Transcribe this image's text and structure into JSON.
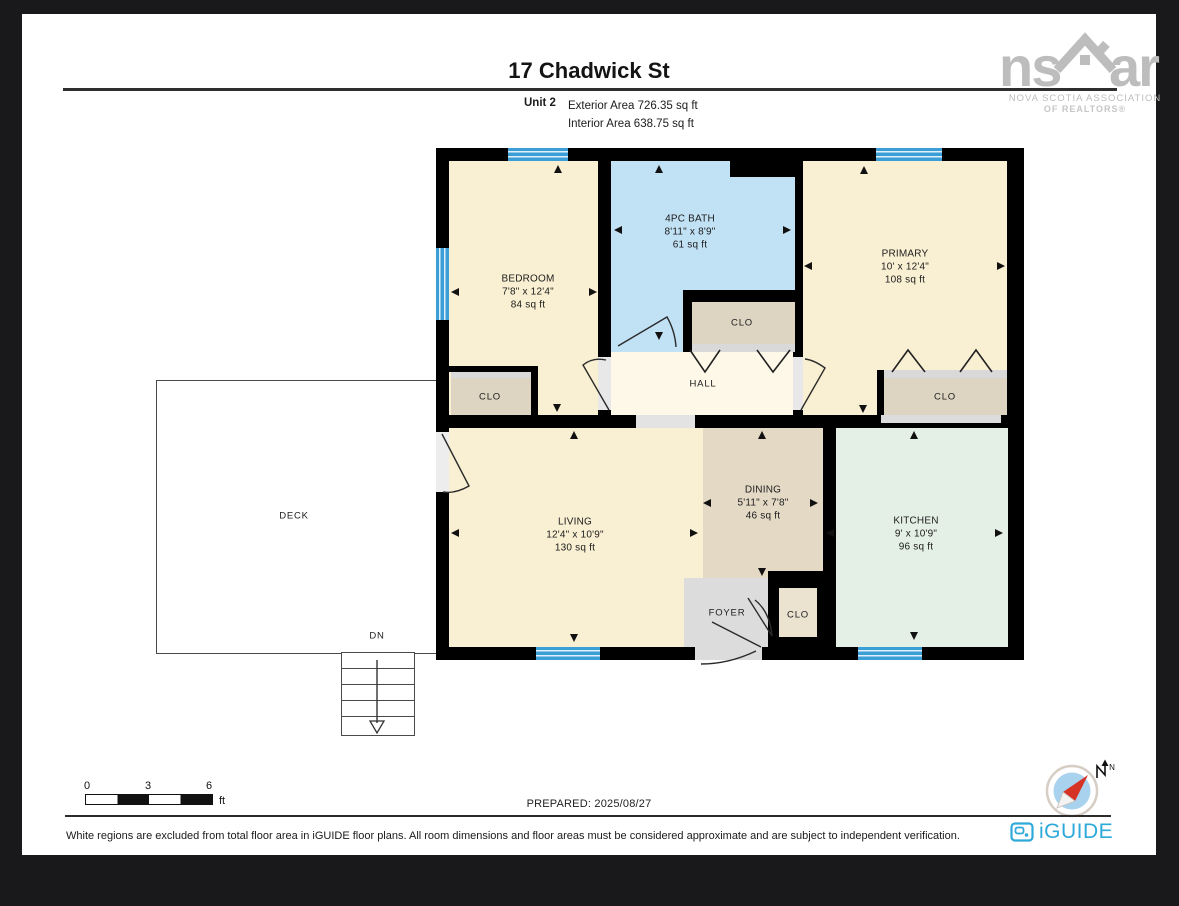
{
  "header": {
    "title": "17 Chadwick St",
    "unit_label": "Unit 2",
    "exterior_area": "Exterior Area 726.35 sq ft",
    "interior_area": "Interior Area 638.75 sq ft"
  },
  "rooms": {
    "bedroom": {
      "name": "BEDROOM",
      "dims": "7'8\" x 12'4\"",
      "area": "84 sq ft"
    },
    "bath": {
      "name": "4PC BATH",
      "dims": "8'11\" x 8'9\"",
      "area": "61 sq ft"
    },
    "primary": {
      "name": "PRIMARY",
      "dims": "10' x 12'4\"",
      "area": "108 sq ft"
    },
    "hall": {
      "name": "HALL"
    },
    "living": {
      "name": "LIVING",
      "dims": "12'4\" x 10'9\"",
      "area": "130 sq ft"
    },
    "dining": {
      "name": "DINING",
      "dims": "5'11\" x 7'8\"",
      "area": "46 sq ft"
    },
    "kitchen": {
      "name": "KITCHEN",
      "dims": "9' x 10'9\"",
      "area": "96 sq ft"
    },
    "foyer": {
      "name": "FOYER"
    },
    "closet": {
      "name": "CLO"
    },
    "deck": {
      "name": "DECK"
    },
    "stairs": {
      "label": "DN"
    }
  },
  "scale_bar": {
    "labels": [
      "0",
      "3",
      "6"
    ],
    "unit": "ft"
  },
  "footer": {
    "prepared": "PREPARED: 2025/08/27",
    "disclaimer": "White regions are excluded from total floor area in iGUIDE floor plans. All room dimensions and floor areas must be considered approximate and are subject to independent verification."
  },
  "branding": {
    "nsar": {
      "ns": "ns",
      "ar": "ar",
      "line1": "NOVA SCOTIA ASSOCIATION",
      "line2": "OF REALTORS®"
    },
    "iguide": {
      "wordmark": "iGUIDE"
    }
  },
  "compass": {
    "north_label": "N"
  },
  "colors": {
    "background": "#19191b",
    "page": "#ffffff",
    "wall": "#000000",
    "room_cream": "#f9efd2",
    "hall_cream": "#fdf8e8",
    "bath_blue": "#c1e1f5",
    "window_blue": "#3c9ed6",
    "closet_beige": "#ddd5c2",
    "dining_tan": "#e3d9c5",
    "kitchen_mint": "#e4efe6",
    "foyer_gray": "#dcdcdd",
    "iguide_blue": "#2da9da",
    "nsar_gray": "#bdbdbd",
    "compass_red": "#d63226"
  }
}
